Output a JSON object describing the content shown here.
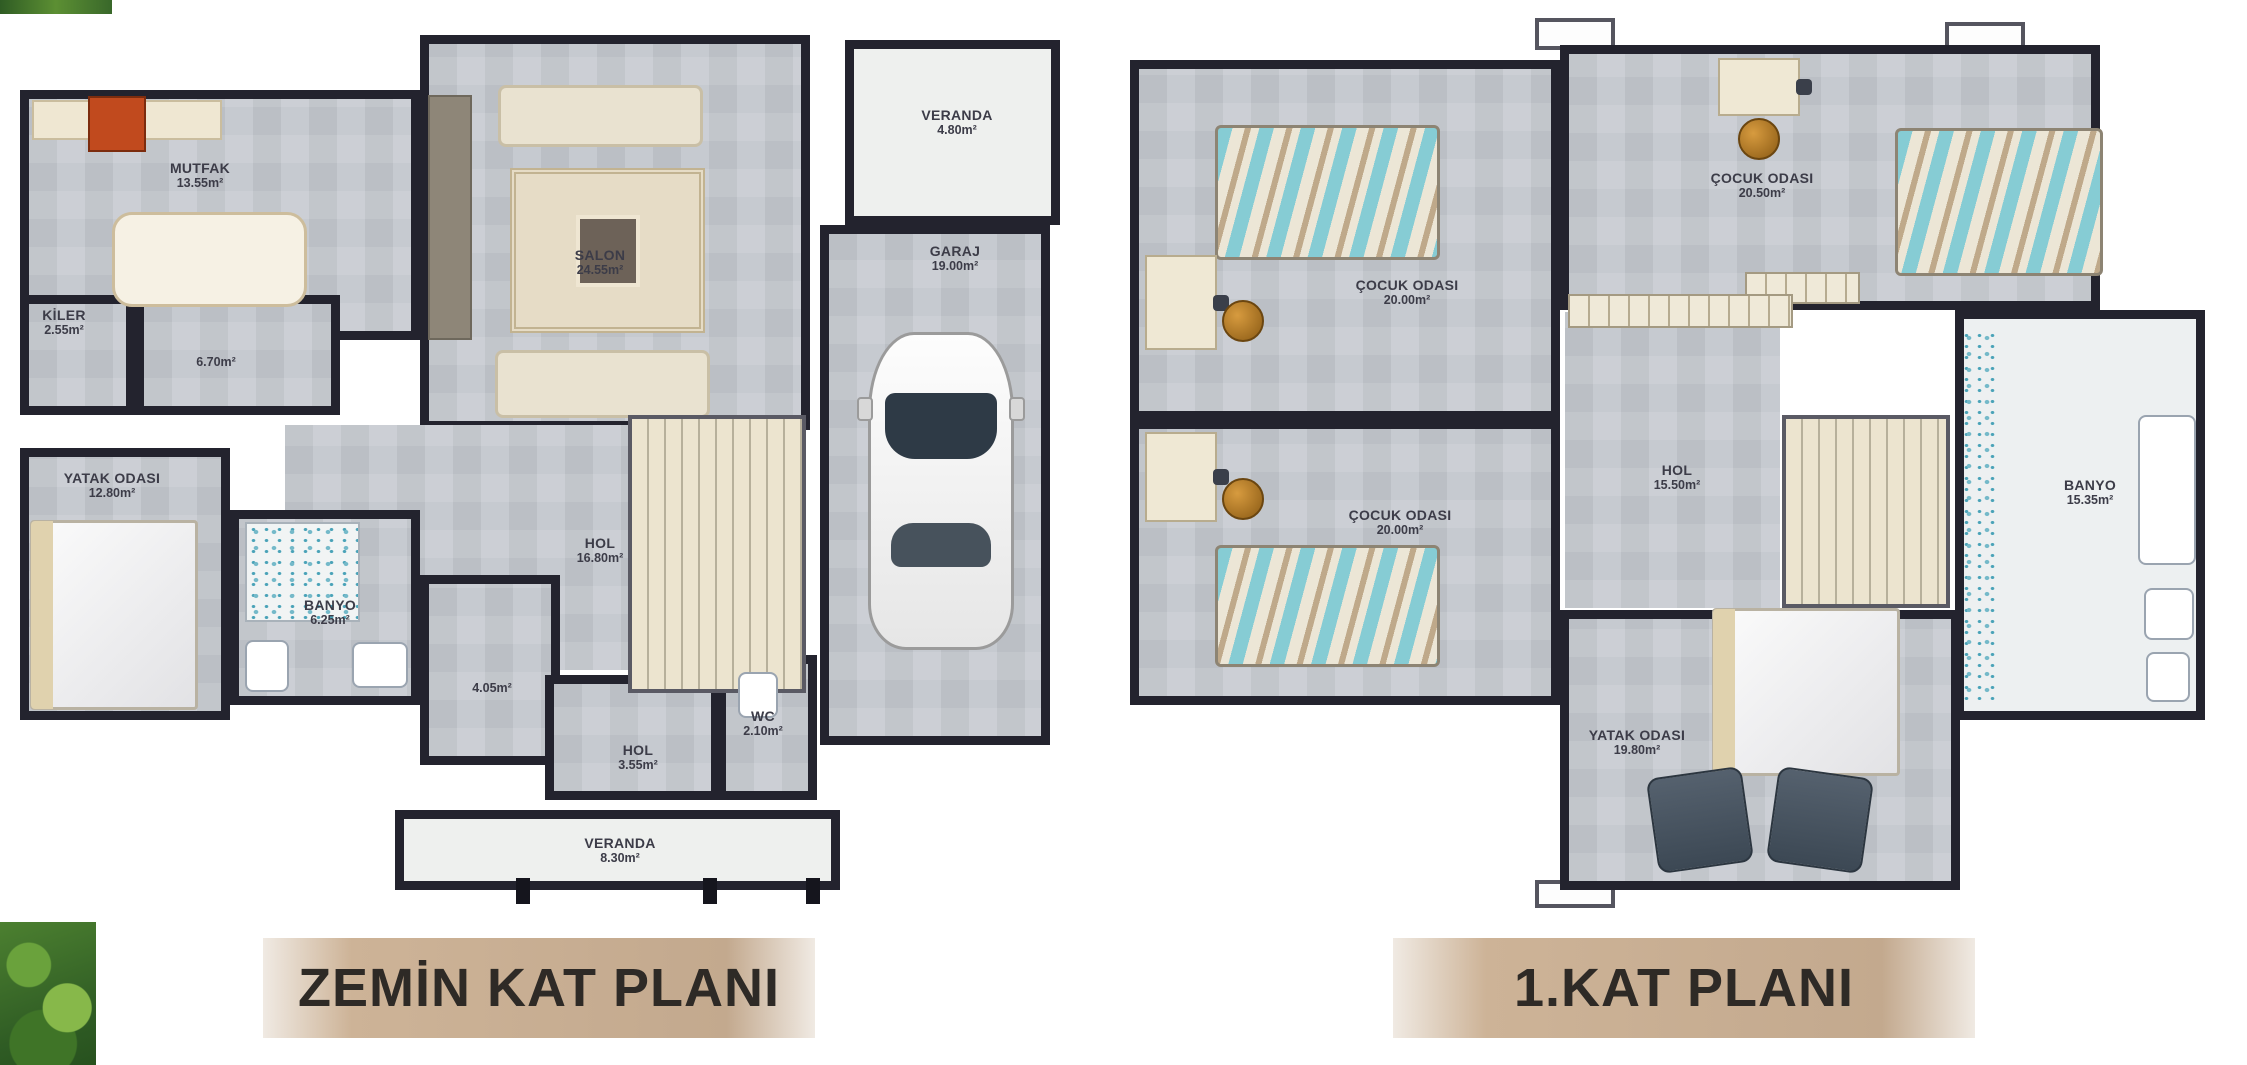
{
  "colors": {
    "floor": "#c6cad0",
    "wall": "#23232e",
    "banner": "#c3a98e",
    "banner_text": "#2e2a26",
    "label_text": "#3c3c48",
    "veranda": "#eef0ee",
    "bed_teal": "#86ccd4"
  },
  "plans": [
    {
      "title": "ZEMİN KAT PLANI",
      "rooms": [
        {
          "name": "MUTFAK",
          "area": "13.55m²"
        },
        {
          "name": "KİLER",
          "area": "2.55m²"
        },
        {
          "name": "",
          "area": "6.70m²"
        },
        {
          "name": "YATAK ODASI",
          "area": "12.80m²"
        },
        {
          "name": "BANYO",
          "area": "6.25m²"
        },
        {
          "name": "SALON",
          "area": "24.55m²"
        },
        {
          "name": "HOL",
          "area": "16.80m²"
        },
        {
          "name": "",
          "area": "4.05m²"
        },
        {
          "name": "HOL",
          "area": "3.55m²"
        },
        {
          "name": "WC",
          "area": "2.10m²"
        },
        {
          "name": "GARAJ",
          "area": "19.00m²"
        },
        {
          "name": "VERANDA",
          "area": "4.80m²"
        },
        {
          "name": "VERANDA",
          "area": "8.30m²"
        }
      ]
    },
    {
      "title": "1.KAT PLANI",
      "rooms": [
        {
          "name": "ÇOCUK ODASI",
          "area": "20.00m²"
        },
        {
          "name": "ÇOCUK ODASI",
          "area": "20.50m²"
        },
        {
          "name": "ÇOCUK ODASI",
          "area": "20.00m²"
        },
        {
          "name": "HOL",
          "area": "15.50m²"
        },
        {
          "name": "BANYO",
          "area": "15.35m²"
        },
        {
          "name": "YATAK ODASI",
          "area": "19.80m²"
        }
      ]
    }
  ]
}
